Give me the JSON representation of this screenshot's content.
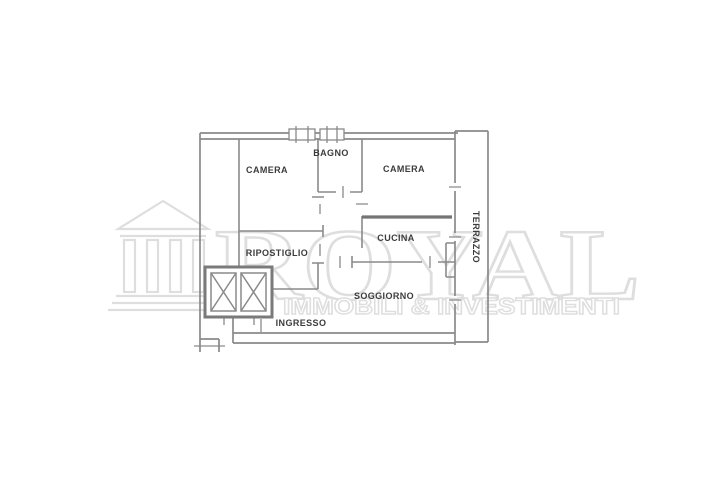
{
  "watermark": {
    "brand": "ROYAL",
    "tagline": "IMMOBILI & INVESTIMENTI",
    "logo_icon": "temple-icon",
    "color": "#dedede"
  },
  "plan": {
    "line_color": "#8a8a8a",
    "thick_line_color": "#757575",
    "label_color": "#3c3c3c",
    "rooms": [
      {
        "label": "CAMERA"
      },
      {
        "label": "BAGNO"
      },
      {
        "label": "CAMERA"
      },
      {
        "label": "CUCINA"
      },
      {
        "label": "RIPOSTIGLIO"
      },
      {
        "label": "SOGGIORNO"
      },
      {
        "label": "INGRESSO"
      },
      {
        "label": "TERRAZZO"
      }
    ],
    "symbols": [
      "elevator-shaft-icon",
      "elevator-shaft-icon",
      "window-icon",
      "window-icon"
    ]
  }
}
